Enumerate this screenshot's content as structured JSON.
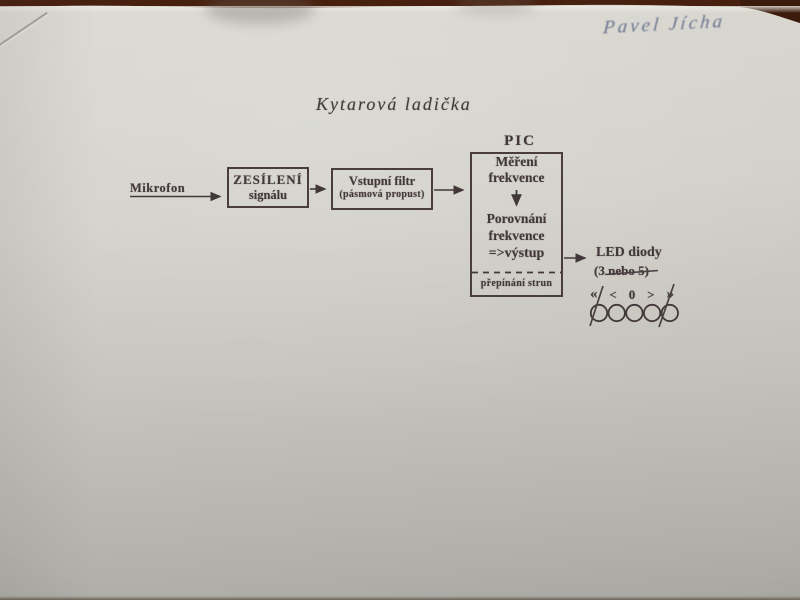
{
  "photo": {
    "handwritten_name": "Pavel Jícha",
    "title": "Kytarová ladička"
  },
  "diagram": {
    "mikrofon_label": "Mikrofon",
    "amp_box": {
      "line1": "ZESÍLENÍ",
      "line2": "signálu"
    },
    "filter_box": {
      "line1": "Vstupní filtr",
      "line2": "(pásmová propust)"
    },
    "pic_label": "PIC",
    "pic_box": {
      "step1_line1": "Měření",
      "step1_line2": "frekvence",
      "step2_line1": "Porovnání",
      "step2_line2": "frekvence",
      "step2_line3": "=>výstup",
      "footer": "přepínání strun"
    },
    "output": {
      "line1": "LED diody",
      "line2_prefix": "(3 ",
      "line2_struck": "nebo 5)"
    },
    "indicator_symbols": [
      "«",
      "<",
      "0",
      ">",
      "»"
    ],
    "led_count": 5
  },
  "colors": {
    "paper": "#cfcdc6",
    "table_wood": "#48200f",
    "ink": "#42383a",
    "handwriting_ink": "#6b7492"
  }
}
